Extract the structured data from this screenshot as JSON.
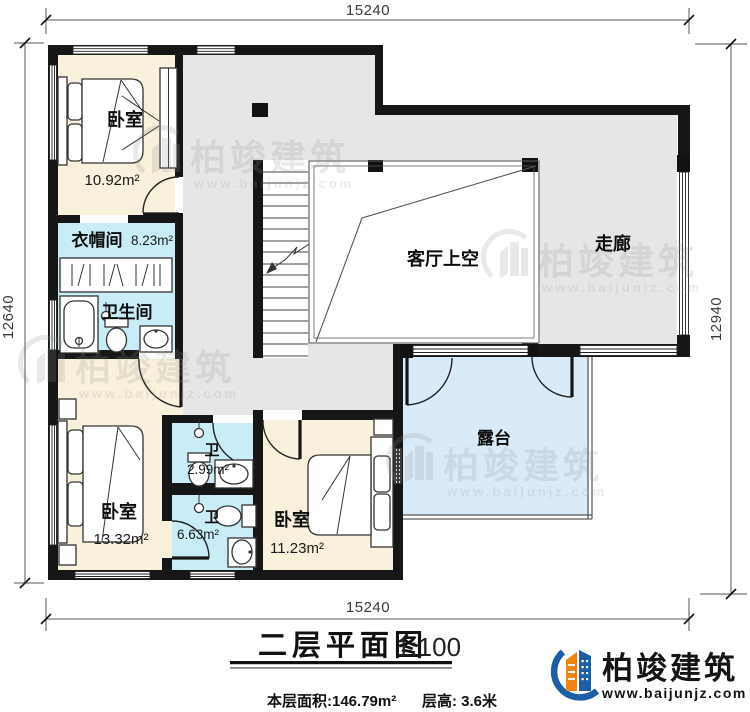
{
  "plan": {
    "dim_top": "15240",
    "dim_bottom": "15240",
    "dim_left": "12640",
    "dim_right": "12940",
    "rooms": {
      "bedroom_tl": {
        "label": "卧室",
        "area": "10.92m²"
      },
      "cloakroom": {
        "label": "衣帽间",
        "area": "8.23m²"
      },
      "bathroom": {
        "label": "卫生间"
      },
      "living_void": {
        "label": "客厅上空"
      },
      "corridor": {
        "label": "走廊"
      },
      "bedroom_bl": {
        "label": "卧室",
        "area": "13.32m²"
      },
      "bath_common": {
        "label": "卫",
        "area": "2.99m²"
      },
      "bath_ensuite": {
        "label": "卫",
        "area": "6.63m²"
      },
      "bedroom_bm": {
        "label": "卧室",
        "area": "11.23m²"
      },
      "terrace": {
        "label": "露台"
      }
    }
  },
  "title_block": {
    "title": "二层平面图",
    "scale": "1:100",
    "floor_area": "本层面积:146.79m²",
    "floor_height": "层高: 3.6米"
  },
  "brand": {
    "name": "柏竣建筑",
    "website": "www.baijunjz.com"
  },
  "watermark": {
    "name": "柏竣建筑",
    "website": "www.baijunjz.com"
  },
  "colors": {
    "wall": "#161616",
    "bedroom_floor": "#faf1dc",
    "bath_floor": "#c9edf6",
    "terrace_floor": "#d9ebf9",
    "hall_floor": "#e6e6e6",
    "brand_blue": "#1b5ea6",
    "brand_orange": "#f5820b"
  }
}
